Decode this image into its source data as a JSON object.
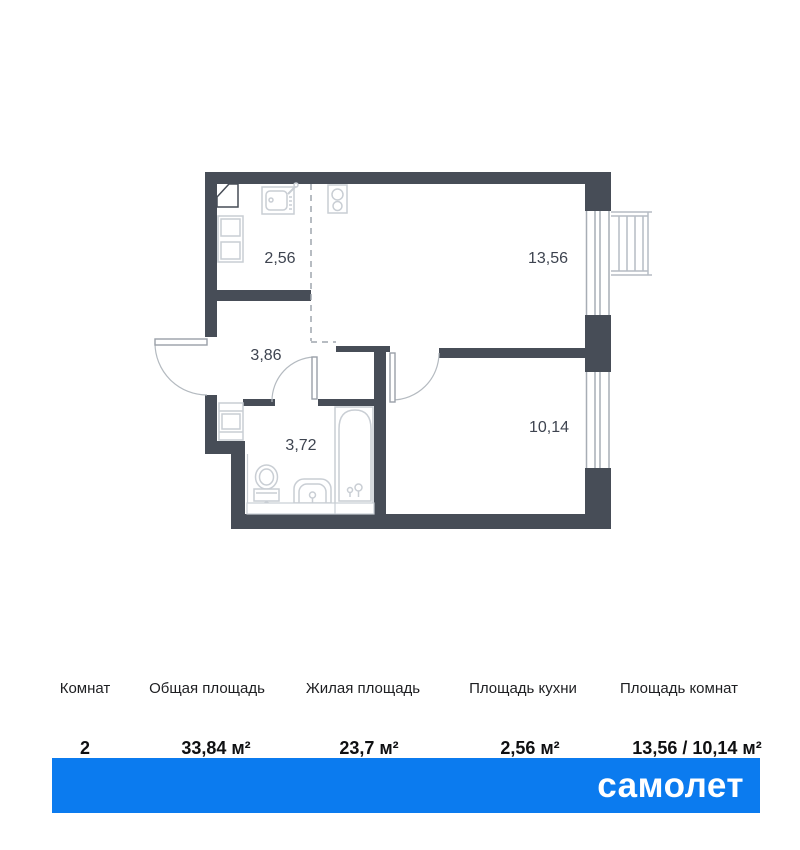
{
  "plan": {
    "rooms": [
      {
        "id": "kitchen",
        "area_label": "2,56"
      },
      {
        "id": "living-room",
        "area_label": "13,56"
      },
      {
        "id": "hallway",
        "area_label": "3,86"
      },
      {
        "id": "bathroom",
        "area_label": "3,72"
      },
      {
        "id": "bedroom",
        "area_label": "10,14"
      }
    ],
    "fixtures": [
      "corner-vent",
      "fridge-cabinet",
      "kitchen-sink",
      "stove",
      "washing-machine",
      "toilet",
      "bathroom-sink",
      "bathtub",
      "balcony-railing",
      "window",
      "entrance-door",
      "bathroom-door",
      "bedroom-door"
    ]
  },
  "summary": {
    "columns": [
      {
        "label": "Комнат",
        "value": "2"
      },
      {
        "label": "Общая площадь",
        "value": "33,84 м²"
      },
      {
        "label": "Жилая площадь",
        "value": "23,7 м²"
      },
      {
        "label": "Площадь кухни",
        "value": "2,56 м²"
      },
      {
        "label": "Площадь комнат",
        "value": "13,56 / 10,14 м²"
      }
    ]
  },
  "footer": {
    "brand": "самолет"
  },
  "colors": {
    "wall": "#474d57",
    "accent": "#0b7bef",
    "fixture_line": "#c9ced4",
    "label_text": "#3e4450"
  }
}
